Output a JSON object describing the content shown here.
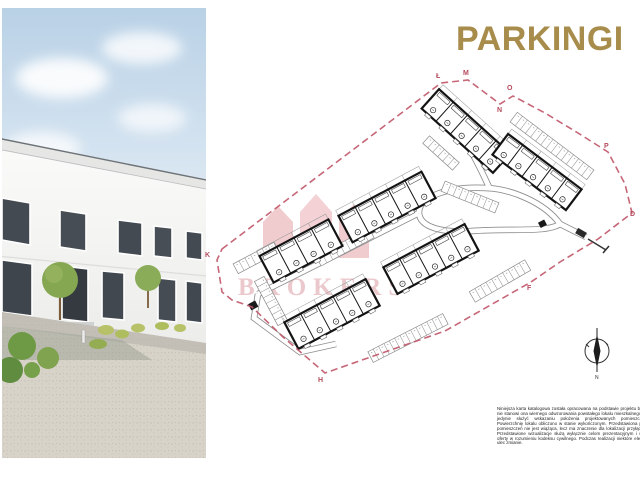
{
  "title": "PARKINGI",
  "plan": {
    "boundary_labels": [
      {
        "id": "K"
      },
      {
        "id": "Ł"
      },
      {
        "id": "M"
      },
      {
        "id": "N"
      },
      {
        "id": "O"
      },
      {
        "id": "P"
      },
      {
        "id": "D"
      },
      {
        "id": "F"
      },
      {
        "id": "H"
      }
    ],
    "compass_label": "N",
    "watermark_text": "BROKERS"
  },
  "disclaimer": {
    "text": "Niniejsza karta katalogowa została opracowana na podstawie projektu budowlanego, nie stanowi ona wiernego odwzorowania powstałego lokalu mieszkalnego. Karty mają jedynie służyć wskazaniu położenia projektowanych pomieszczeń lokalu. Powierzchnię lokalu obliczono w stanie wykończonym. Przedstawiona powierzchnia pomieszczeń nie jest wiążąca, lecz ma znaczenie dla lokalizacji przyłączy instalacji. Przedstawione wizualizacje służą wyłącznie celom prezentacyjnym i nie stanowią oferty w rozumieniu kodeksu cywilnego. Podczas realizacji niektóre elementy mogą ulec zmianie."
  },
  "colors": {
    "accent_gold": "#A78C4B",
    "boundary_pink": "#C05568",
    "watermark_pink": "#E49AA0"
  }
}
